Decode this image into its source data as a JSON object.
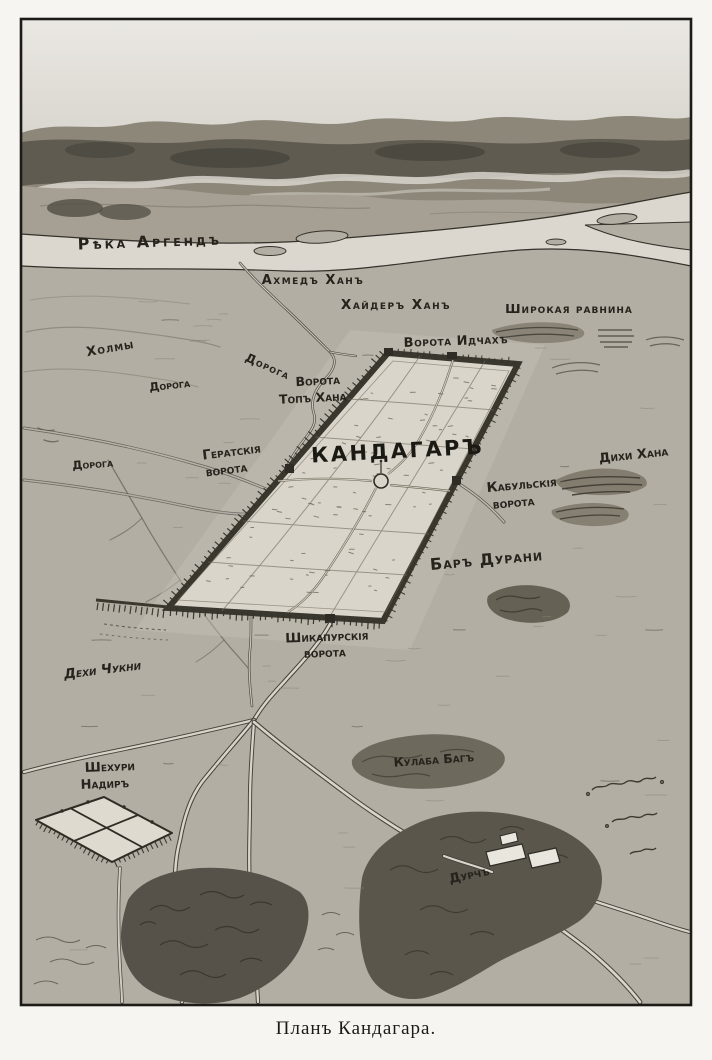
{
  "figure": {
    "caption": "Планъ Кандагара.",
    "type": "bird's-eye plan engraving"
  },
  "map": {
    "city": "КАНДАГАРЪ",
    "labels": {
      "river": "Рѣка Аргендъ",
      "ahmed_khan": "Ахмедъ Ханъ",
      "khaider_khan": "Хайдеръ Ханъ",
      "wide_plain": "Широкая равнина",
      "gate_idchakh": "Ворота Идчахъ",
      "hills": "Холмы",
      "road_upper": "Дорога",
      "gate_top_khana_1": "Ворота",
      "gate_top_khana_2": "Топъ Хана",
      "road_middle": "Дорога",
      "road_lower": "Дорога",
      "gate_herat_1": "Гератскія",
      "gate_herat_2": "ворота",
      "gate_kabul_1": "Кабульскія",
      "gate_kabul_2": "ворота",
      "dikhi_khana": "Дихи Хана",
      "bar_durani": "Баръ Дурани",
      "gate_shikapur_1": "Шикапурскія",
      "gate_shikapur_2": "ворота",
      "dekhi_chukni": "Дехи Чукни",
      "shekhuri_nadir_1": "Шехури",
      "shekhuri_nadir_2": "Надиръ",
      "kulaba_bag": "Кулаба Багъ",
      "durch": "Дурчъ"
    }
  },
  "colors": {
    "paper": "#f7f5f1",
    "ink": "#26231d",
    "ground": "#b3aea3",
    "river": "#dbd7ce",
    "city_wall": "#3a372e",
    "vegetation": "#57534a"
  }
}
